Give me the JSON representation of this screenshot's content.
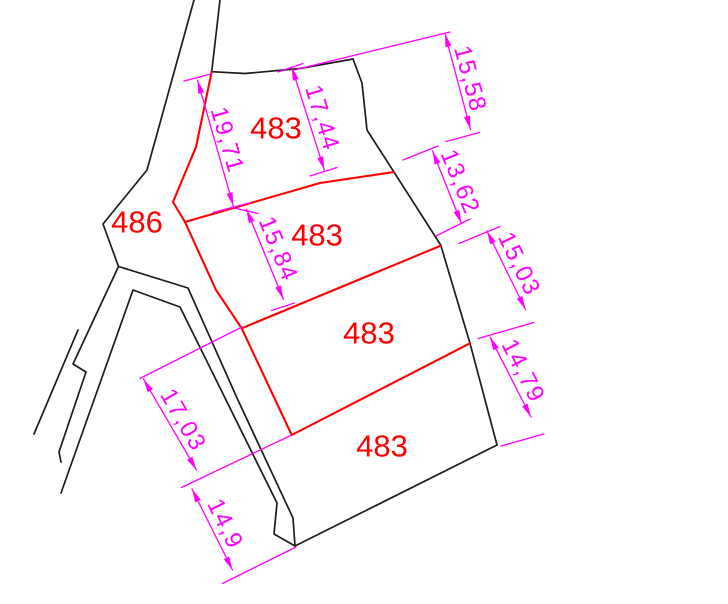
{
  "drawing": {
    "type": "cadastral-parcel-plan",
    "colors": {
      "boundary_black": "#1c1c1c",
      "parcel_red": "#fe0000",
      "dimension_magenta": "#ff00ff",
      "background": "#ffffff"
    },
    "parcels": [
      {
        "label": "486"
      },
      {
        "label": "483"
      },
      {
        "label": "483"
      },
      {
        "label": "483"
      },
      {
        "label": "483"
      }
    ],
    "dimensions": [
      {
        "value": "19,71"
      },
      {
        "value": "17,44"
      },
      {
        "value": "15,58"
      },
      {
        "value": "13,62"
      },
      {
        "value": "15,03"
      },
      {
        "value": "14,79"
      },
      {
        "value": "15,84"
      },
      {
        "value": "17,03"
      },
      {
        "value": "14,9"
      }
    ]
  }
}
